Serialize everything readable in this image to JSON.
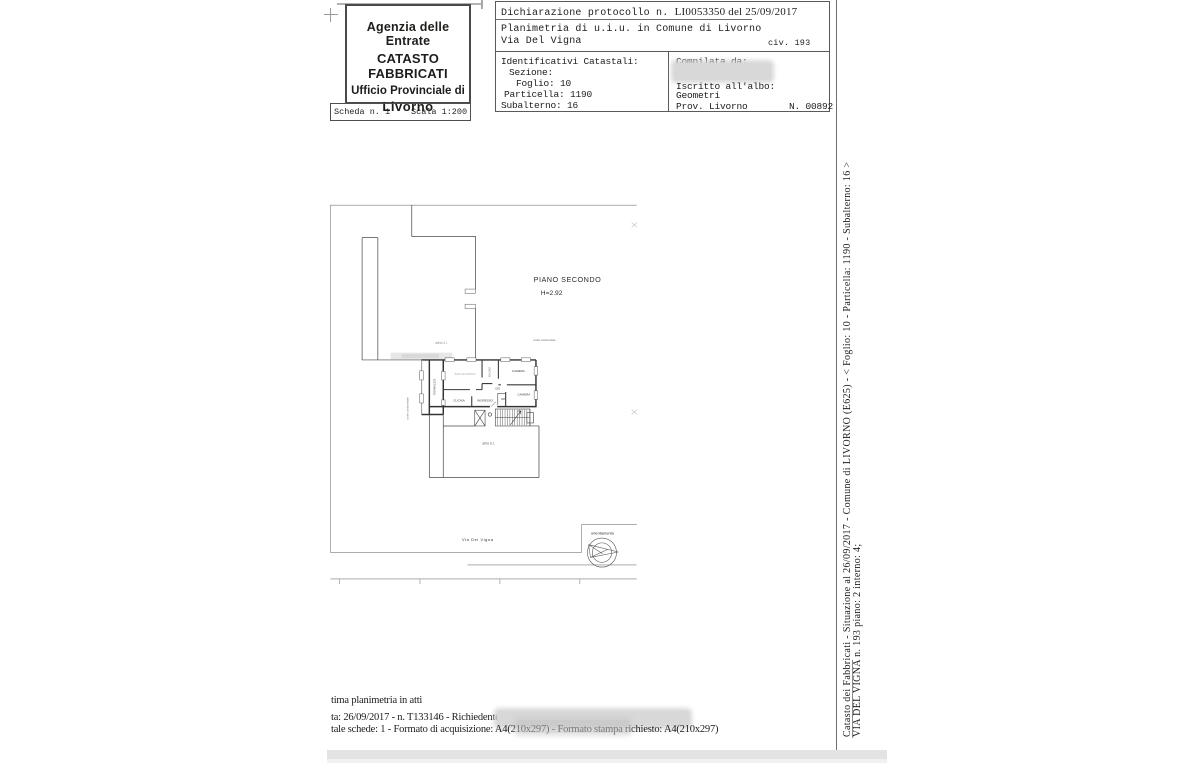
{
  "colors": {
    "ink": "#1d1d1b",
    "faded_label": "#a3a3a3",
    "redaction": "#d8d8d8",
    "frame_line": "#7b7b7b"
  },
  "logo_box": {
    "line1": "Agenzia delle Entrate",
    "line2": "CATASTO FABBRICATI",
    "line3": "Ufficio Provinciale di",
    "line4": "Livorno"
  },
  "scheda": {
    "label": "Scheda n. 1",
    "scale": "Scala 1:200"
  },
  "declaration": {
    "protocol_prefix": "Dichiarazione protocollo n.",
    "protocol_value": "LI0053350 del 25/09/2017",
    "subject": "Planimetria di u.i.u. in Comune di Livorno",
    "street": "Via Del Vigna",
    "civic": "civ. 193"
  },
  "identifiers": {
    "title": "Identificativi Catastali:",
    "sezione": "Sezione:",
    "foglio": "Foglio: 10",
    "particella": "Particella: 1190",
    "subalterno": "Subalterno: 16"
  },
  "compiler": {
    "label": "Compilata da:",
    "albo_label": "Iscritto all'albo:",
    "albo_value": "Geometri",
    "prov": "Prov. Livorno",
    "reg_number": "N. 00892"
  },
  "plan": {
    "floor": "PIANO SECONDO",
    "height": "H=2.92",
    "rooms": {
      "soggiorno": "SOGGIORNO",
      "cucina": "CUCINA",
      "ingresso": "INGRESSO",
      "terrazzo": "TERRAZZO",
      "bagno": "BAGNO",
      "camera_top": "CAMERA",
      "camera_bottom": "CAMERA",
      "dis": "DIS",
      "rip": "RIP"
    },
    "other_unit_top": "altra U.I.",
    "other_unit_bottom": "altra U.I.",
    "courtyard_right": "cortile condominiale",
    "courtyard_left": "cortile condominiale",
    "street_label": "Via  Del  Vigna",
    "orientation": "orientamento"
  },
  "side_strip": {
    "line1": "Catasto dei Fabbricati - Situazione al 26/09/2017 - Comune di LIVORNO (E625) - < Foglio: 10 - Particella: 1190 - Subalterno: 16 >",
    "line2": "VIA DEL VIGNA n. 193 piano: 2 interno: 4;"
  },
  "footer": {
    "line1": "tima planimetria in atti",
    "line2": "ta: 26/09/2017 - n. T133146 - Richiedente:",
    "line3": "tale schede: 1 - Formato di acquisizione: A4(210x297)  - Formato stampa richiesto: A4(210x297)"
  }
}
